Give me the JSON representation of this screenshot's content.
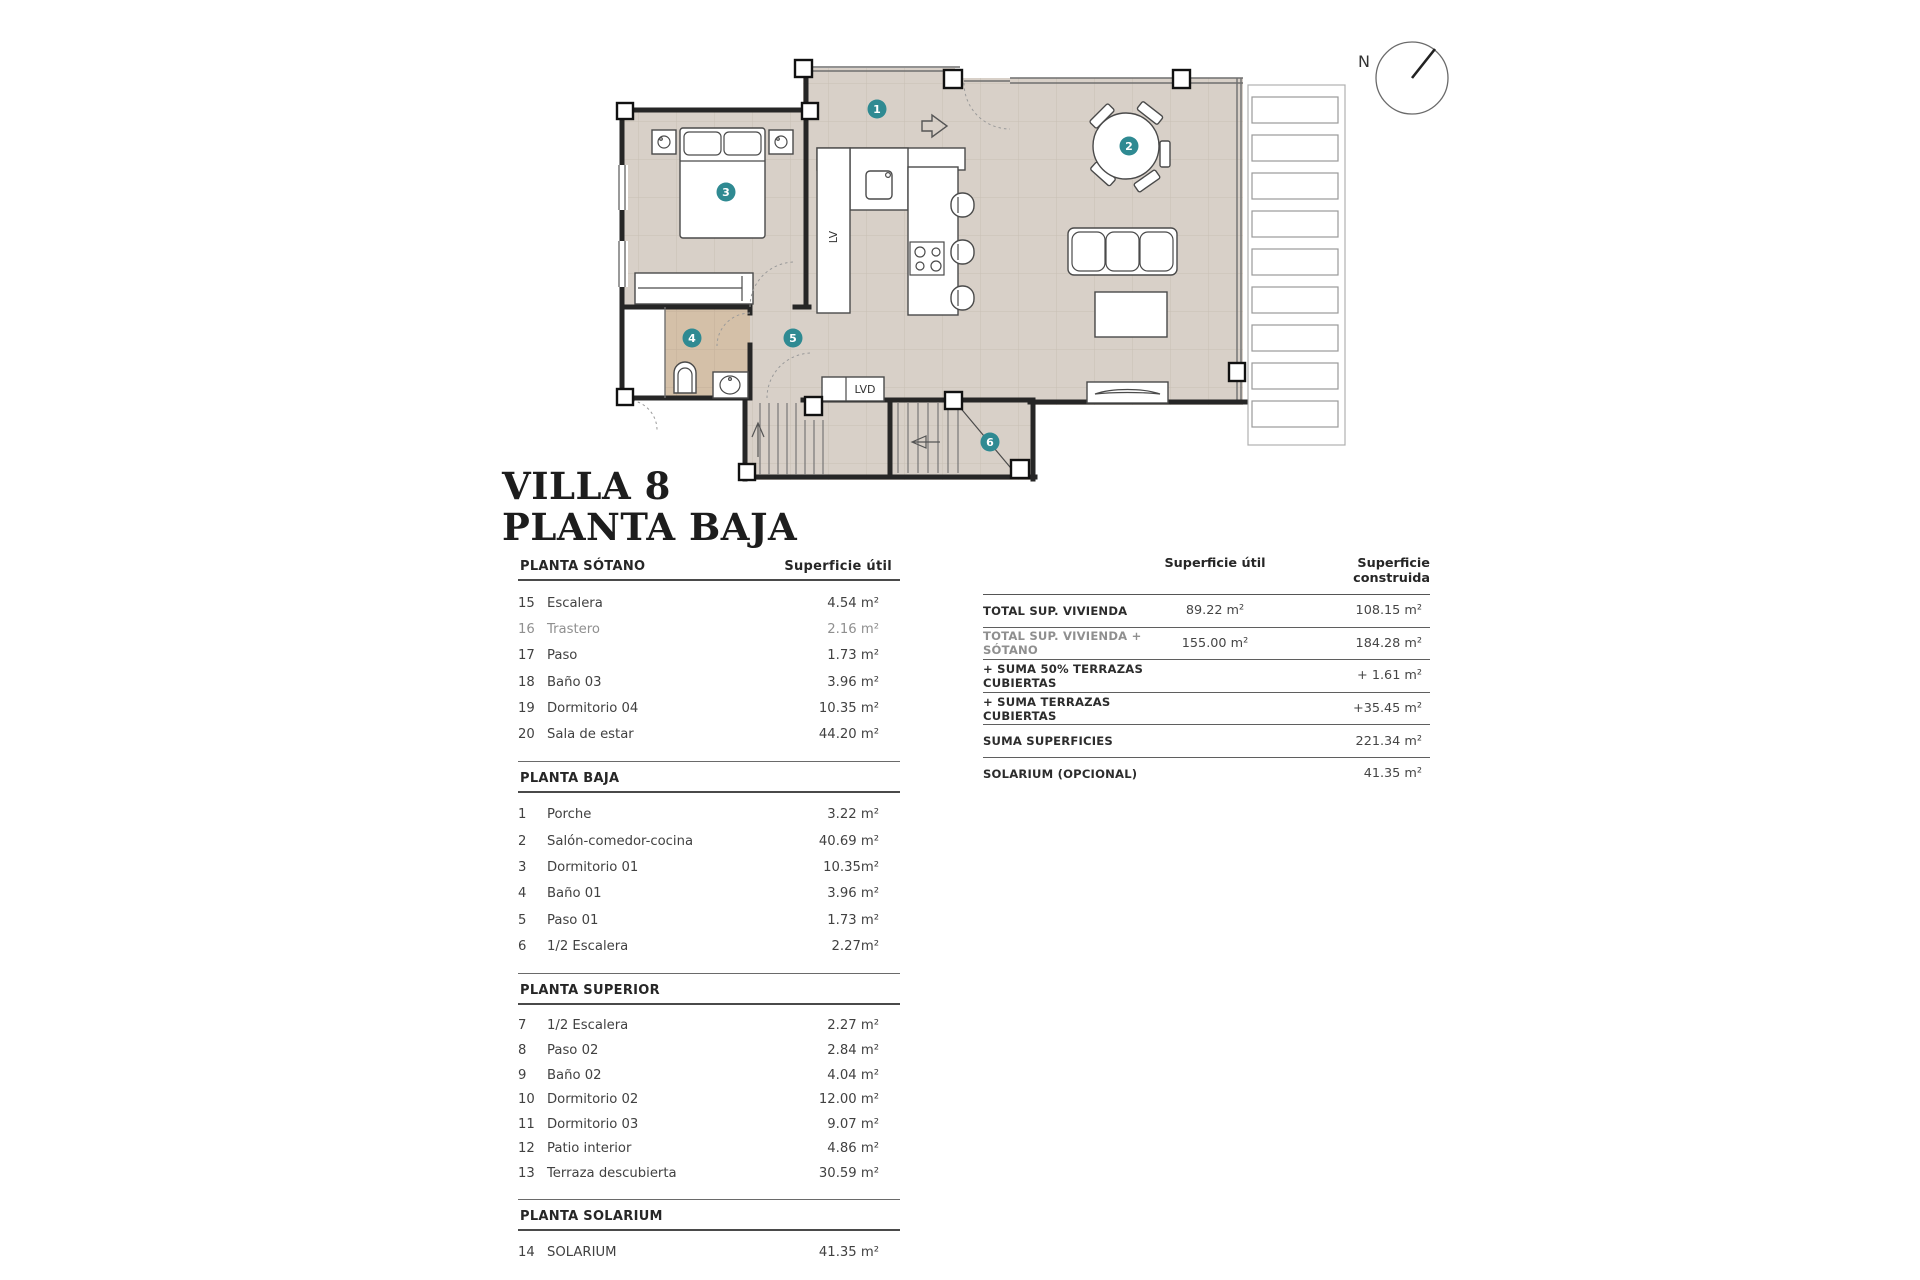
{
  "title": {
    "line1": "VILLA 8",
    "line2": "PLANTA BAJA"
  },
  "plan": {
    "badges": [
      "1",
      "2",
      "3",
      "4",
      "5",
      "6"
    ],
    "labels": {
      "lv": "LV",
      "lvd": "LVD",
      "north": "N"
    },
    "colors": {
      "floor": "#d8d0c8",
      "bath": "#d4c0a8",
      "badge": "#2f8a92",
      "wall": "#262626"
    }
  },
  "left_table": {
    "area_header": "Superficie útil",
    "sections": [
      {
        "name": "PLANTA SÓTANO",
        "rows": [
          {
            "num": "15",
            "label": "Escalera",
            "value": "4.54 m²"
          },
          {
            "num": "16",
            "label": "Trastero",
            "value": "2.16 m²",
            "muted": true
          },
          {
            "num": "17",
            "label": "Paso",
            "value": "1.73 m²"
          },
          {
            "num": "18",
            "label": "Baño 03",
            "value": "3.96 m²"
          },
          {
            "num": "19",
            "label": "Dormitorio 04",
            "value": "10.35 m²"
          },
          {
            "num": "20",
            "label": "Sala de estar",
            "value": "44.20 m²"
          }
        ]
      },
      {
        "name": "PLANTA BAJA",
        "rows": [
          {
            "num": "1",
            "label": "Porche",
            "value": "3.22 m²"
          },
          {
            "num": "2",
            "label": "Salón-comedor-cocina",
            "value": "40.69 m²"
          },
          {
            "num": "3",
            "label": "Dormitorio 01",
            "value": "10.35m²"
          },
          {
            "num": "4",
            "label": "Baño 01",
            "value": "3.96 m²"
          },
          {
            "num": "5",
            "label": "Paso 01",
            "value": "1.73 m²"
          },
          {
            "num": "6",
            "label": "1/2 Escalera",
            "value": "2.27m²"
          }
        ]
      },
      {
        "name": "PLANTA SUPERIOR",
        "rows": [
          {
            "num": "7",
            "label": "1/2 Escalera",
            "value": "2.27 m²"
          },
          {
            "num": "8",
            "label": "Paso 02",
            "value": "2.84 m²"
          },
          {
            "num": "9",
            "label": "Baño 02",
            "value": "4.04 m²"
          },
          {
            "num": "10",
            "label": "Dormitorio 02",
            "value": "12.00 m²"
          },
          {
            "num": "11",
            "label": "Dormitorio 03",
            "value": "9.07 m²"
          },
          {
            "num": "12",
            "label": "Patio interior",
            "value": "4.86 m²"
          },
          {
            "num": "13",
            "label": "Terraza descubierta",
            "value": "30.59 m²"
          }
        ]
      },
      {
        "name": "PLANTA SOLARIUM",
        "rows": [
          {
            "num": "14",
            "label": "SOLARIUM",
            "value": "41.35 m²"
          }
        ]
      }
    ]
  },
  "summary_table": {
    "col1_header": "Superficie útil",
    "col2_header": "Superficie construida",
    "rows": [
      {
        "label": "TOTAL SUP. VIVIENDA",
        "util": "89.22 m²",
        "construida": "108.15 m²"
      },
      {
        "label": "TOTAL SUP. VIVIENDA + SÓTANO",
        "util": "155.00  m²",
        "construida": "184.28 m²",
        "muted": true
      },
      {
        "label": "+ SUMA 50% TERRAZAS CUBIERTAS",
        "util": "",
        "construida": "+ 1.61 m²"
      },
      {
        "label": "+ SUMA TERRAZAS CUBIERTAS",
        "util": "",
        "construida": "+35.45 m²"
      },
      {
        "label": "SUMA SUPERFICIES",
        "util": "",
        "construida": "221.34 m²"
      },
      {
        "label": "SOLARIUM (OPCIONAL)",
        "util": "",
        "construida": "41.35 m²"
      }
    ]
  }
}
